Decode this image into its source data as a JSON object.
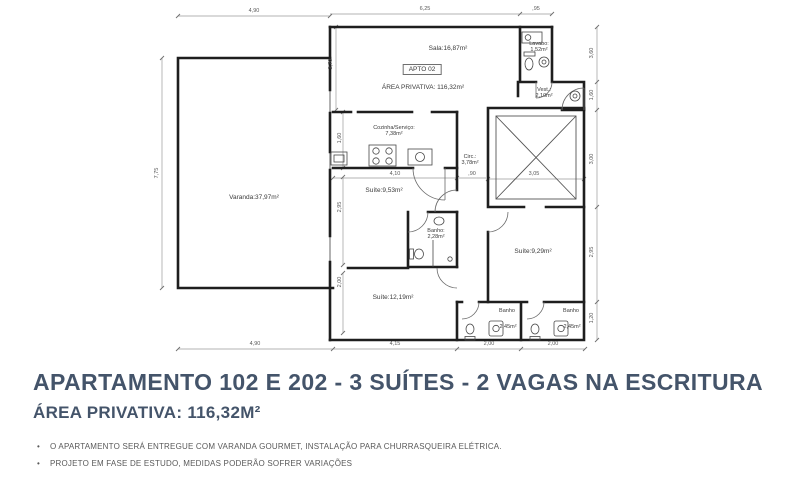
{
  "colors": {
    "title": "#44546a",
    "notes": "#595959",
    "walls": "#1e1e1e"
  },
  "plan": {
    "labels": {
      "varanda": "Varanda:37,97m²",
      "sala": "Sala:16,87m²",
      "apto": "APTO 02",
      "area": "ÁREA PRIVATIVA: 116,32m²",
      "lavabo1": "Lavabo:",
      "lavabo2": "1,52m²",
      "vest1": "Vest.:",
      "vest2": "2,10m²",
      "cozinha1": "Cozinha/Serviço:",
      "cozinha2": "7,38m²",
      "circ1": "Circ.:",
      "circ2": "3,78m²",
      "suite953": "Suíte:9,53m²",
      "banho2281": "Banho:",
      "banho2282": "2,28m²",
      "suite929": "Suíte:9,29m²",
      "suite1219": "Suíte:12,19m²",
      "banhoL1": "Banho",
      "banhoL2": "2,45m²",
      "banhoR1": "Banho",
      "banhoR2": "2,45m²"
    },
    "dims": {
      "top": [
        "4,90",
        "6,25",
        ",95"
      ],
      "bottom": [
        "4,90",
        "4,15",
        "2,00",
        "2,00"
      ],
      "left": [
        "7,75"
      ],
      "right": [
        "3,60",
        "1,60",
        "3,00",
        "2,95",
        "1,20"
      ],
      "inner": {
        "d270": "2,70",
        "d160": "1,60",
        "d295": "2,95",
        "d200": "2,00",
        "d410": "4,10",
        "d90": ",90",
        "d305": "3,05"
      }
    }
  },
  "footer": {
    "title": "APARTAMENTO 102 E 202 - 3 SUÍTES - 2 VAGAS NA ESCRITURA",
    "subtitle": "ÁREA PRIVATIVA: 116,32M²",
    "notes": [
      "O APARTAMENTO SERÁ ENTREGUE COM VARANDA GOURMET, INSTALAÇÃO PARA CHURRASQUEIRA ELÉTRICA.",
      "PROJETO EM FASE DE ESTUDO, MEDIDAS PODERÃO SOFRER VARIAÇÕES"
    ]
  }
}
